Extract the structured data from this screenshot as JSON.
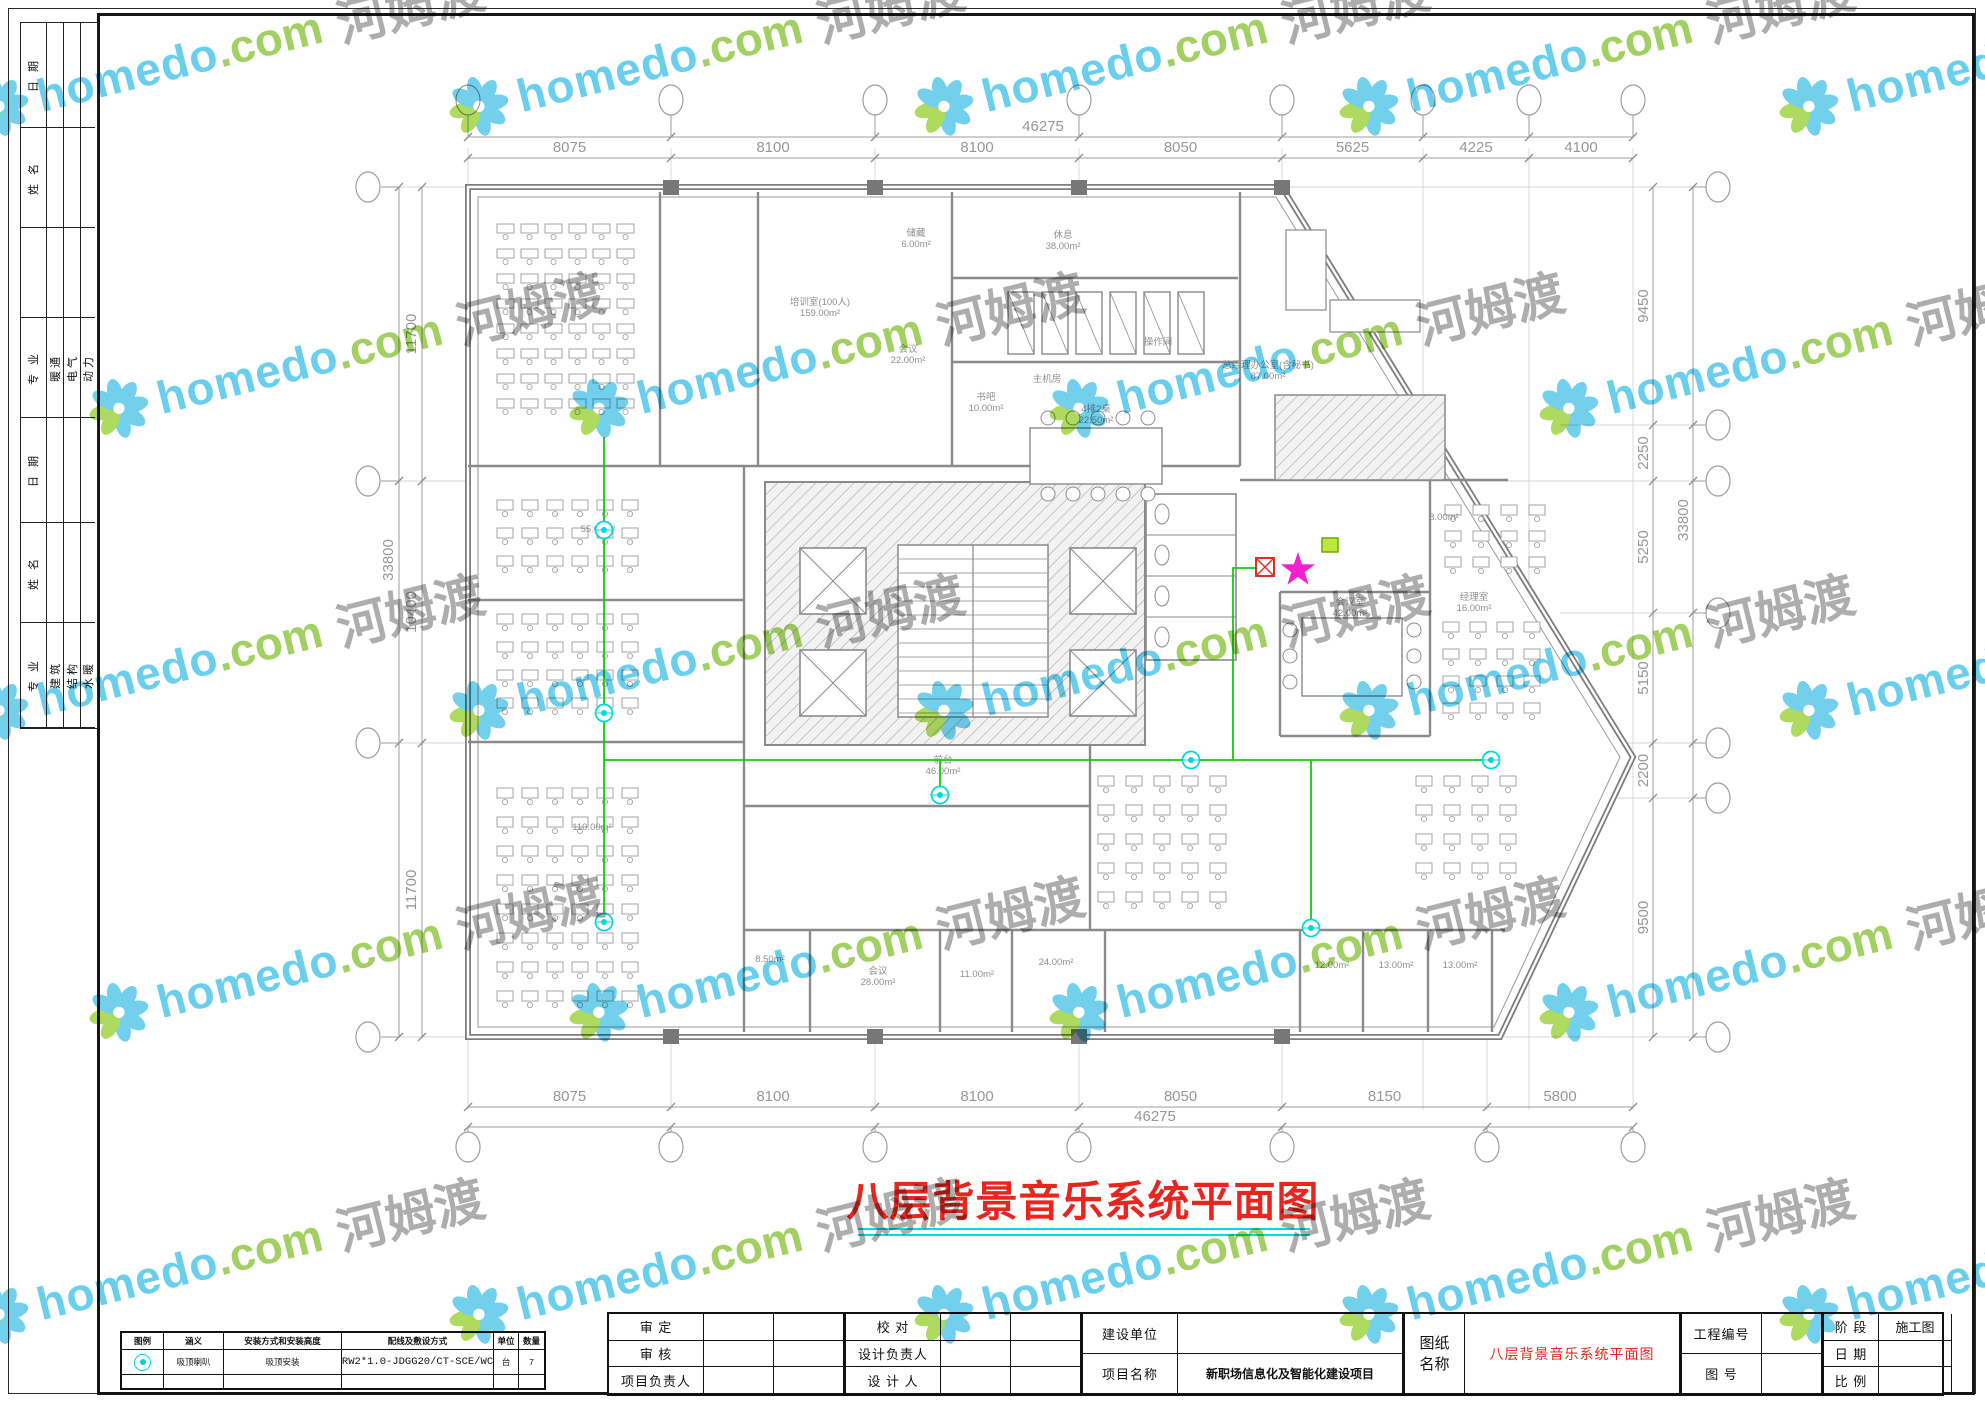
{
  "title": {
    "text": "八层背景音乐系统平面图"
  },
  "watermark": {
    "brand": "homedo",
    "tld": ".com",
    "cn": "河姆渡"
  },
  "sidebar": {
    "sections": [
      {
        "h": 105,
        "cells": [
          "日 期",
          "",
          "",
          ""
        ]
      },
      {
        "h": 100,
        "cells": [
          "姓 名",
          "",
          "",
          ""
        ]
      },
      {
        "h": 90,
        "cells": [
          "",
          "",
          "",
          ""
        ]
      },
      {
        "h": 100,
        "cells": [
          "专 业",
          "暖通",
          "电气",
          "动力"
        ]
      },
      {
        "h": 105,
        "cells": [
          "日 期",
          "",
          "",
          ""
        ]
      },
      {
        "h": 100,
        "cells": [
          "姓 名",
          "",
          "",
          ""
        ]
      },
      {
        "h": 105,
        "cells": [
          "专 业",
          "建筑",
          "结构",
          "水暖"
        ]
      }
    ]
  },
  "legend": {
    "headers": [
      "图例",
      "涵义",
      "安装方式和安装高度",
      "配线及敷设方式",
      "单位",
      "数量"
    ],
    "rows": [
      {
        "icon": "ceiling-speaker",
        "meaning": "吸顶喇叭",
        "install": "吸顶安装",
        "wiring": "RW2*1.0-JDGG20/CT-SCE/WC",
        "unit": "台",
        "qty": "7"
      }
    ]
  },
  "titleblock": {
    "group1": [
      [
        "审 定",
        ""
      ],
      [
        "审 核",
        ""
      ],
      [
        "项目负责人",
        ""
      ]
    ],
    "group2": [
      [
        "校  对",
        ""
      ],
      [
        "设计负责人",
        ""
      ],
      [
        "设 计 人",
        ""
      ]
    ],
    "group3": [
      [
        "建设单位",
        ""
      ],
      [
        "项目名称",
        "新职场信息化及智能化建设项目"
      ]
    ],
    "sheet_label": "图纸名称",
    "sheet_name": "八层背景音乐系统平面图",
    "group5": [
      [
        "工程编号",
        ""
      ],
      [
        "图  号",
        ""
      ]
    ],
    "group6": [
      [
        "阶 段",
        "施工图"
      ],
      [
        "日 期",
        ""
      ],
      [
        "比 例",
        ""
      ]
    ]
  },
  "dimensions": {
    "top": {
      "total": "46275",
      "segments": [
        "8075",
        "8100",
        "8100",
        "8050",
        "5625",
        "4225",
        "4100"
      ]
    },
    "bottom": {
      "total": "46275",
      "segments": [
        "8075",
        "8100",
        "8100",
        "8050",
        "8150",
        "5800"
      ]
    },
    "left": {
      "total": "33800",
      "segments": [
        "11700",
        "10400",
        "11700"
      ]
    },
    "right": {
      "total": "33800",
      "segments": [
        "9450",
        "2250",
        "5250",
        "5150",
        "2200",
        "9500"
      ]
    }
  },
  "plan": {
    "rooms": [
      {
        "name": "培训室(100人)",
        "area": "159.00m²",
        "x": 820,
        "y": 305
      },
      {
        "name": "储藏",
        "area": "6.00m²",
        "x": 916,
        "y": 236
      },
      {
        "name": "休息",
        "area": "38.00m²",
        "x": 1063,
        "y": 238
      },
      {
        "name": "会议",
        "area": "22.00m²",
        "x": 908,
        "y": 352
      },
      {
        "name": "书吧",
        "area": "10.00m²",
        "x": 986,
        "y": 400
      },
      {
        "name": "主机房",
        "area": "",
        "x": 1047,
        "y": 382
      },
      {
        "name": "操作间",
        "area": "",
        "x": 1158,
        "y": 345
      },
      {
        "name": "总经理办公室(含秘书)",
        "area": "87.00m²",
        "x": 1268,
        "y": 368
      },
      {
        "name": "4排2桌",
        "area": "22.50m²",
        "x": 1096,
        "y": 412
      },
      {
        "name": "",
        "area": "8.00m²",
        "x": 1444,
        "y": 520
      },
      {
        "name": "经理室",
        "area": "16.00m²",
        "x": 1474,
        "y": 600
      },
      {
        "name": "会议室",
        "area": "42.00m²",
        "x": 1350,
        "y": 605
      },
      {
        "name": "",
        "area": "55.00m²",
        "x": 598,
        "y": 532
      },
      {
        "name": "",
        "area": "110.00m²",
        "x": 592,
        "y": 830
      },
      {
        "name": "前台",
        "area": "46.00m²",
        "x": 943,
        "y": 763
      },
      {
        "name": "",
        "area": "8.50m²",
        "x": 770,
        "y": 962
      },
      {
        "name": "会议",
        "area": "28.00m²",
        "x": 878,
        "y": 974
      },
      {
        "name": "",
        "area": "11.00m²",
        "x": 977,
        "y": 977
      },
      {
        "name": "",
        "area": "24.00m²",
        "x": 1056,
        "y": 965
      },
      {
        "name": "",
        "area": "12.00m²",
        "x": 1332,
        "y": 968
      },
      {
        "name": "",
        "area": "13.00m²",
        "x": 1396,
        "y": 968
      },
      {
        "name": "",
        "area": "13.00m²",
        "x": 1460,
        "y": 968
      }
    ],
    "speakers": [
      {
        "x": 604,
        "y": 530
      },
      {
        "x": 604,
        "y": 713
      },
      {
        "x": 604,
        "y": 922
      },
      {
        "x": 940,
        "y": 795
      },
      {
        "x": 1191,
        "y": 760
      },
      {
        "x": 1491,
        "y": 760
      },
      {
        "x": 1311,
        "y": 928
      }
    ],
    "wiring": [
      [
        [
          604,
          437
        ],
        [
          604,
          922
        ]
      ],
      [
        [
          604,
          760
        ],
        [
          1491,
          760
        ]
      ],
      [
        [
          940,
          760
        ],
        [
          940,
          795
        ]
      ],
      [
        [
          1233,
          760
        ],
        [
          1233,
          568
        ],
        [
          1257,
          568
        ]
      ],
      [
        [
          1311,
          760
        ],
        [
          1311,
          928
        ]
      ]
    ],
    "devices": {
      "source_box": {
        "x": 1265,
        "y": 567
      },
      "star": {
        "x": 1298,
        "y": 570
      },
      "volume_control": {
        "x": 1330,
        "y": 545
      }
    }
  }
}
